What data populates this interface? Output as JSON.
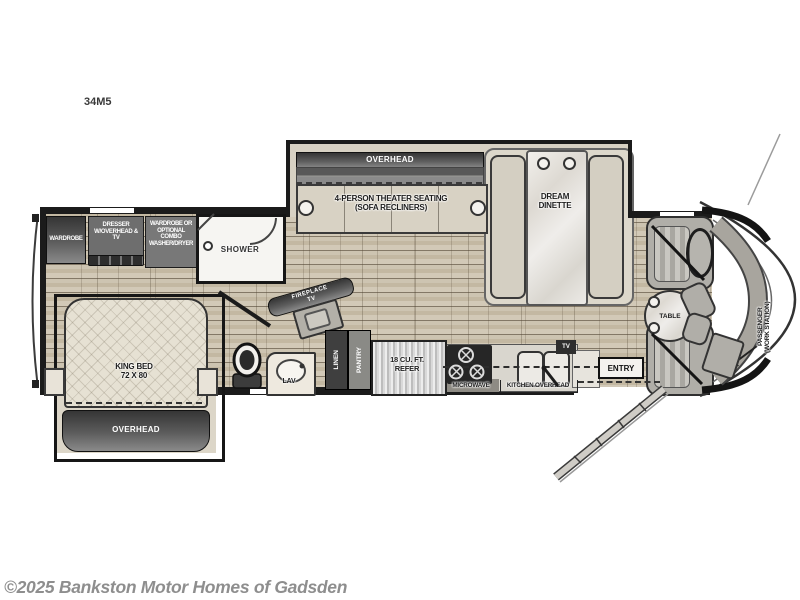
{
  "meta": {
    "model": "34M5",
    "copyright": "©2025 Bankston Motor Homes of Gadsden"
  },
  "labels": {
    "overhead_top": "OVERHEAD",
    "theater_line1": "4-PERSON THEATER SEATING",
    "theater_line2": "(SOFA RECLINERS)",
    "dinette_line1": "DREAM",
    "dinette_line2": "DINETTE",
    "wardrobe": "WARDROBE",
    "dresser": "DRESSER W/OVERHEAD & TV",
    "wardrobe_optional": "WARDROBE OR OPTIONAL COMBO WASHER/DRYER",
    "shower": "SHOWER",
    "king_bed_line1": "KING BED",
    "king_bed_line2": "72 X 80",
    "overhead_bed": "OVERHEAD",
    "fireplace_line1": "FIREPLACE",
    "fireplace_line2": "TV",
    "lav": "LAV",
    "linen": "LINEN",
    "pantry": "PANTRY",
    "refer_line1": "18 CU. FT.",
    "refer_line2": "REFER",
    "microwave": "MICROWAVE",
    "kitchen_overhead": "KITCHEN OVERHEAD",
    "tv_small": "TV",
    "entry": "ENTRY",
    "table": "TABLE",
    "workstation_line1": "PASSENGER",
    "workstation_line2": "(WORK STATION)"
  },
  "colors": {
    "wall": "#1b1b1b",
    "floor_base": "#c7bda9",
    "slide_interior": "#d7d1c3",
    "cabinet_dark": "#4a4a4a",
    "marble": "#ecebe6",
    "copyright_gray": "#8e8e8e"
  }
}
